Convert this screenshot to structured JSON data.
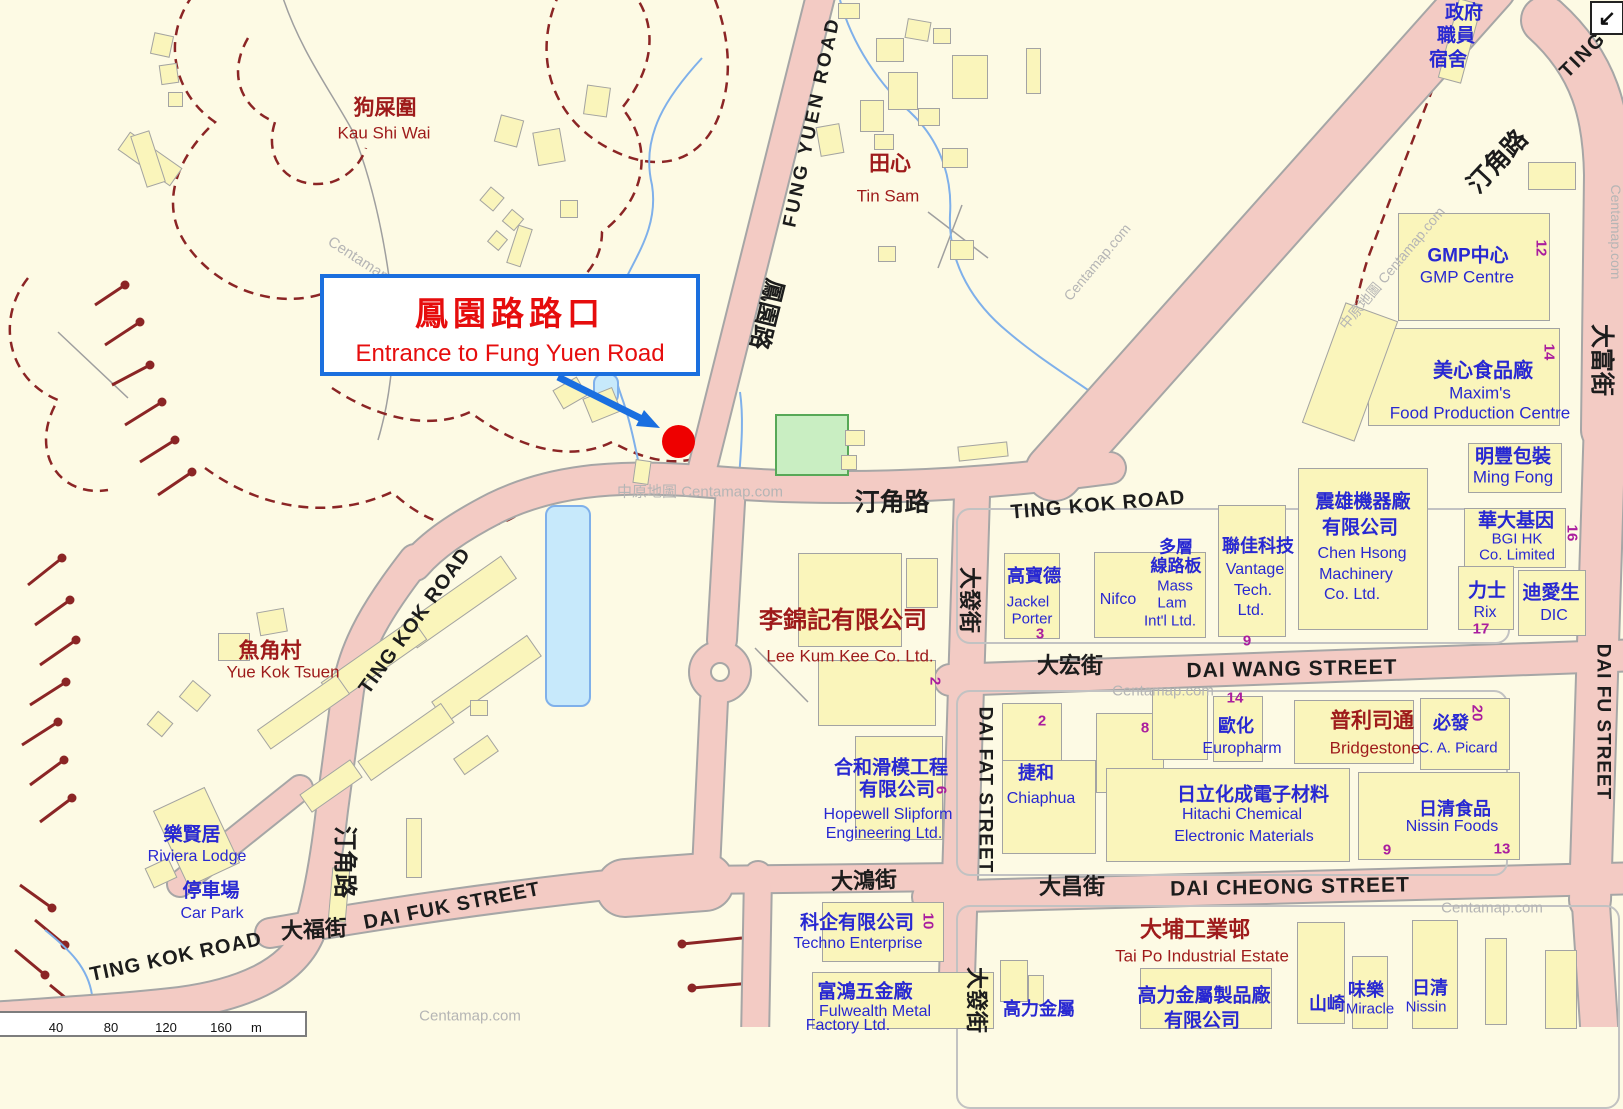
{
  "callout": {
    "title_zh": "鳳園路路口",
    "title_en": "Entrance to Fung Yuen Road"
  },
  "marker": {
    "type": "red-dot"
  },
  "nav_icon": {
    "glyph": "↙"
  },
  "scale_bar": {
    "ticks": [
      "40",
      "80",
      "120",
      "160"
    ],
    "unit": "m"
  },
  "colors": {
    "background": "#fdfae4",
    "road_fill": "#f3cbc4",
    "road_casing": "#a6a6a6",
    "building": "#faf5bb",
    "park": "#c9eec2",
    "water": "#7fb0ea",
    "contour": "#8b2525",
    "road_text": "#1c1c1c",
    "place_text": "#9e1b1b",
    "facility_text": "#2828d2",
    "lot_number_text": "#aa1d9e",
    "watermark_text": "#b5b5b5",
    "callout_border": "#1b6fde",
    "callout_text": "#e60d0d",
    "marker_red": "#ee0000"
  },
  "labels": [
    {
      "id": "fung-yuen-road",
      "t": "FUNG YUEN ROAD",
      "k": "road",
      "x": 812,
      "y": 122,
      "s": 19,
      "r": -78,
      "b": 1,
      "ls": 3
    },
    {
      "id": "fung-yuen-road-zh",
      "t": "鳳園路",
      "k": "road",
      "x": 766,
      "y": 314,
      "s": 24,
      "r": 104,
      "b": 1
    },
    {
      "id": "ting-kok-road-ne",
      "t": "TING",
      "k": "road",
      "x": 1583,
      "y": 55,
      "s": 20,
      "r": -45,
      "b": 1,
      "ls": 2
    },
    {
      "id": "ting-kok-road-ne-zh",
      "t": "汀角路",
      "k": "road",
      "x": 1498,
      "y": 162,
      "s": 25,
      "r": -47,
      "b": 1
    },
    {
      "id": "ting-kok-road-c",
      "t": "TING KOK ROAD",
      "k": "road",
      "x": 1098,
      "y": 505,
      "s": 20,
      "r": -5,
      "b": 1,
      "ls": 1
    },
    {
      "id": "ting-kok-road-c-zh",
      "t": "汀角路",
      "k": "road",
      "x": 892,
      "y": 503,
      "s": 25,
      "r": 0,
      "b": 1
    },
    {
      "id": "ting-kok-road-w",
      "t": "TING KOK ROAD",
      "k": "road",
      "x": 415,
      "y": 621,
      "s": 20,
      "r": -54,
      "b": 1,
      "ls": 1
    },
    {
      "id": "ting-kok-road-w-zh",
      "t": "汀角路",
      "k": "road",
      "x": 344,
      "y": 862,
      "s": 24,
      "r": 90,
      "b": 1
    },
    {
      "id": "ting-kok-road-sw",
      "t": "TING KOK ROAD",
      "k": "road",
      "x": 176,
      "y": 957,
      "s": 20,
      "r": -12,
      "b": 1,
      "ls": 1
    },
    {
      "id": "dai-fuk-street-zh",
      "t": "大福街",
      "k": "road",
      "x": 314,
      "y": 930,
      "s": 22,
      "r": -3,
      "b": 1
    },
    {
      "id": "dai-fuk-street",
      "t": "DAI FUK STREET",
      "k": "road",
      "x": 452,
      "y": 906,
      "s": 20,
      "r": -11,
      "b": 1,
      "ls": 1
    },
    {
      "id": "dai-hung-street-zh",
      "t": "大鴻街",
      "k": "road",
      "x": 864,
      "y": 881,
      "s": 22,
      "r": -2,
      "b": 1
    },
    {
      "id": "dai-fat-street-zh",
      "t": "大發街",
      "k": "road",
      "x": 969,
      "y": 600,
      "s": 22,
      "r": 90,
      "b": 1
    },
    {
      "id": "dai-fat-street",
      "t": "DAI FAT STREET",
      "k": "road",
      "x": 985,
      "y": 790,
      "s": 19,
      "r": 90,
      "b": 1,
      "ls": 1
    },
    {
      "id": "dai-fat-street-zh-s",
      "t": "大發街",
      "k": "road",
      "x": 976,
      "y": 1000,
      "s": 22,
      "r": 90,
      "b": 1
    },
    {
      "id": "dai-wang-street-zh",
      "t": "大宏街",
      "k": "road",
      "x": 1070,
      "y": 666,
      "s": 22,
      "r": 0,
      "b": 1
    },
    {
      "id": "dai-wang-street",
      "t": "DAI WANG STREET",
      "k": "road",
      "x": 1292,
      "y": 669,
      "s": 21,
      "r": -1,
      "b": 1,
      "ls": 1
    },
    {
      "id": "dai-cheong-street-zh",
      "t": "大昌街",
      "k": "road",
      "x": 1072,
      "y": 887,
      "s": 22,
      "r": 0,
      "b": 1
    },
    {
      "id": "dai-cheong-street",
      "t": "DAI CHEONG STREET",
      "k": "road",
      "x": 1290,
      "y": 887,
      "s": 21,
      "r": -1,
      "b": 1,
      "ls": 1
    },
    {
      "id": "dai-fu-street-zh",
      "t": "大富街",
      "k": "road",
      "x": 1601,
      "y": 360,
      "s": 24,
      "r": 90,
      "b": 1
    },
    {
      "id": "dai-fu-street",
      "t": "DAI FU STREET",
      "k": "road",
      "x": 1603,
      "y": 722,
      "s": 19,
      "r": 90,
      "b": 1,
      "ls": 1
    },
    {
      "id": "kau-shi-wai-zh",
      "t": "狗屎圍",
      "k": "place",
      "x": 385,
      "y": 108,
      "s": 21,
      "b": 1
    },
    {
      "id": "kau-shi-wai",
      "t": "Kau Shi Wai",
      "k": "place",
      "x": 384,
      "y": 133,
      "s": 17
    },
    {
      "id": "tin-sam-zh",
      "t": "田心",
      "k": "place",
      "x": 890,
      "y": 164,
      "s": 21,
      "b": 1
    },
    {
      "id": "tin-sam",
      "t": "Tin Sam",
      "k": "place",
      "x": 888,
      "y": 196,
      "s": 17
    },
    {
      "id": "yue-kok-tsuen-zh",
      "t": "魚角村",
      "k": "place",
      "x": 270,
      "y": 651,
      "s": 21,
      "b": 1
    },
    {
      "id": "yue-kok-tsuen",
      "t": "Yue Kok Tsuen",
      "k": "place",
      "x": 283,
      "y": 672,
      "s": 17
    },
    {
      "id": "lee-kum-kee-zh",
      "t": "李錦記有限公司",
      "k": "place",
      "x": 843,
      "y": 621,
      "s": 24,
      "b": 1
    },
    {
      "id": "lee-kum-kee",
      "t": "Lee Kum Kee Co. Ltd.",
      "k": "place",
      "x": 850,
      "y": 656,
      "s": 17
    },
    {
      "id": "tai-po-industrial-estate-zh",
      "t": "大埔工業邨",
      "k": "place",
      "x": 1195,
      "y": 930,
      "s": 22,
      "b": 1
    },
    {
      "id": "tai-po-industrial-estate",
      "t": "Tai Po Industrial Estate",
      "k": "place",
      "x": 1202,
      "y": 956,
      "s": 17
    },
    {
      "id": "bridgestone-zh",
      "t": "普利司通",
      "k": "place",
      "x": 1372,
      "y": 721,
      "s": 21,
      "b": 1
    },
    {
      "id": "bridgestone",
      "t": "Bridgestone",
      "k": "place",
      "x": 1375,
      "y": 748,
      "s": 17
    },
    {
      "id": "govt-quarters-zh-1",
      "t": "政府",
      "k": "fac",
      "x": 1464,
      "y": 13,
      "s": 19,
      "b": 1
    },
    {
      "id": "govt-quarters-zh-2",
      "t": "職員",
      "k": "fac",
      "x": 1456,
      "y": 36,
      "s": 19,
      "b": 1
    },
    {
      "id": "govt-quarters-zh-3",
      "t": "宿舍",
      "k": "fac",
      "x": 1448,
      "y": 60,
      "s": 19,
      "b": 1
    },
    {
      "id": "gmp-centre-zh",
      "t": "GMP中心",
      "k": "fac",
      "x": 1468,
      "y": 256,
      "s": 19,
      "b": 1
    },
    {
      "id": "gmp-centre",
      "t": "GMP Centre",
      "k": "fac",
      "x": 1467,
      "y": 277,
      "s": 17
    },
    {
      "id": "maxims-zh",
      "t": "美心食品廠",
      "k": "fac",
      "x": 1483,
      "y": 371,
      "s": 20,
      "b": 1
    },
    {
      "id": "maxims",
      "t": "Maxim's",
      "k": "fac",
      "x": 1480,
      "y": 393,
      "s": 17
    },
    {
      "id": "maxims-2",
      "t": "Food Production Centre",
      "k": "fac",
      "x": 1480,
      "y": 413,
      "s": 17
    },
    {
      "id": "ming-fong-zh",
      "t": "明豐包裝",
      "k": "fac",
      "x": 1513,
      "y": 457,
      "s": 19,
      "b": 1
    },
    {
      "id": "ming-fong",
      "t": "Ming Fong",
      "k": "fac",
      "x": 1513,
      "y": 477,
      "s": 17
    },
    {
      "id": "bgi-zh",
      "t": "華大基因",
      "k": "fac",
      "x": 1516,
      "y": 521,
      "s": 19,
      "b": 1
    },
    {
      "id": "bgi-1",
      "t": "BGI HK",
      "k": "fac",
      "x": 1517,
      "y": 539,
      "s": 15
    },
    {
      "id": "bgi-2",
      "t": "Co. Limited",
      "k": "fac",
      "x": 1517,
      "y": 555,
      "s": 15
    },
    {
      "id": "rix-zh",
      "t": "力士",
      "k": "fac",
      "x": 1487,
      "y": 591,
      "s": 19,
      "b": 1
    },
    {
      "id": "rix",
      "t": "Rix",
      "k": "fac",
      "x": 1485,
      "y": 613,
      "s": 16
    },
    {
      "id": "dic-zh",
      "t": "迪愛生",
      "k": "fac",
      "x": 1551,
      "y": 593,
      "s": 19,
      "b": 1
    },
    {
      "id": "dic",
      "t": "DIC",
      "k": "fac",
      "x": 1554,
      "y": 616,
      "s": 16
    },
    {
      "id": "chen-hsong-zh-1",
      "t": "震雄機器廠",
      "k": "fac",
      "x": 1363,
      "y": 502,
      "s": 19,
      "b": 1
    },
    {
      "id": "chen-hsong-zh-2",
      "t": "有限公司",
      "k": "fac",
      "x": 1360,
      "y": 528,
      "s": 19,
      "b": 1
    },
    {
      "id": "chen-hsong-1",
      "t": "Chen Hsong",
      "k": "fac",
      "x": 1362,
      "y": 554,
      "s": 16
    },
    {
      "id": "chen-hsong-2",
      "t": "Machinery",
      "k": "fac",
      "x": 1356,
      "y": 575,
      "s": 16
    },
    {
      "id": "chen-hsong-3",
      "t": "Co. Ltd.",
      "k": "fac",
      "x": 1352,
      "y": 595,
      "s": 16
    },
    {
      "id": "vantage-zh",
      "t": "聯佳科技",
      "k": "fac",
      "x": 1258,
      "y": 546,
      "s": 18,
      "b": 1
    },
    {
      "id": "vantage-1",
      "t": "Vantage",
      "k": "fac",
      "x": 1255,
      "y": 570,
      "s": 16
    },
    {
      "id": "vantage-2",
      "t": "Tech.",
      "k": "fac",
      "x": 1253,
      "y": 591,
      "s": 16
    },
    {
      "id": "vantage-3",
      "t": "Ltd.",
      "k": "fac",
      "x": 1251,
      "y": 611,
      "s": 16
    },
    {
      "id": "mass-lam-zh-1",
      "t": "多層",
      "k": "fac",
      "x": 1176,
      "y": 547,
      "s": 17,
      "b": 1
    },
    {
      "id": "mass-lam-zh-2",
      "t": "線路板",
      "k": "fac",
      "x": 1176,
      "y": 566,
      "s": 17,
      "b": 1
    },
    {
      "id": "mass-lam-1",
      "t": "Mass",
      "k": "fac",
      "x": 1175,
      "y": 586,
      "s": 15
    },
    {
      "id": "mass-lam-2",
      "t": "Lam",
      "k": "fac",
      "x": 1172,
      "y": 603,
      "s": 15
    },
    {
      "id": "mass-lam-3",
      "t": "Int'l Ltd.",
      "k": "fac",
      "x": 1170,
      "y": 621,
      "s": 15
    },
    {
      "id": "nifco",
      "t": "Nifco",
      "k": "fac",
      "x": 1118,
      "y": 600,
      "s": 16
    },
    {
      "id": "jackel-porter-zh",
      "t": "高寶德",
      "k": "fac",
      "x": 1034,
      "y": 576,
      "s": 18,
      "b": 1
    },
    {
      "id": "jackel-porter-1",
      "t": "Jackel",
      "k": "fac",
      "x": 1028,
      "y": 602,
      "s": 15
    },
    {
      "id": "jackel-porter-2",
      "t": "Porter",
      "k": "fac",
      "x": 1032,
      "y": 619,
      "s": 15
    },
    {
      "id": "europharm-zh",
      "t": "歐化",
      "k": "fac",
      "x": 1236,
      "y": 726,
      "s": 18,
      "b": 1
    },
    {
      "id": "europharm",
      "t": "Europharm",
      "k": "fac",
      "x": 1242,
      "y": 749,
      "s": 16
    },
    {
      "id": "ca-picard-zh",
      "t": "必發",
      "k": "fac",
      "x": 1451,
      "y": 723,
      "s": 18,
      "b": 1
    },
    {
      "id": "ca-picard",
      "t": "C. A. Picard",
      "k": "fac",
      "x": 1458,
      "y": 748,
      "s": 15
    },
    {
      "id": "chiaphua-zh",
      "t": "捷和",
      "k": "fac",
      "x": 1036,
      "y": 773,
      "s": 18,
      "b": 1
    },
    {
      "id": "chiaphua",
      "t": "Chiaphua",
      "k": "fac",
      "x": 1041,
      "y": 799,
      "s": 16
    },
    {
      "id": "hitachi-zh",
      "t": "日立化成電子材料",
      "k": "fac",
      "x": 1253,
      "y": 795,
      "s": 19,
      "b": 1
    },
    {
      "id": "hitachi-1",
      "t": "Hitachi Chemical",
      "k": "fac",
      "x": 1242,
      "y": 815,
      "s": 16
    },
    {
      "id": "hitachi-2",
      "t": "Electronic Materials",
      "k": "fac",
      "x": 1244,
      "y": 837,
      "s": 16
    },
    {
      "id": "nissin-foods-zh",
      "t": "日清食品",
      "k": "fac",
      "x": 1455,
      "y": 809,
      "s": 18,
      "b": 1
    },
    {
      "id": "nissin-foods",
      "t": "Nissin Foods",
      "k": "fac",
      "x": 1452,
      "y": 827,
      "s": 16
    },
    {
      "id": "hopewell-zh-1",
      "t": "合和滑模工程",
      "k": "fac",
      "x": 891,
      "y": 768,
      "s": 19,
      "b": 1
    },
    {
      "id": "hopewell-zh-2",
      "t": "有限公司",
      "k": "fac",
      "x": 897,
      "y": 790,
      "s": 19,
      "b": 1
    },
    {
      "id": "hopewell-1",
      "t": "Hopewell Slipform",
      "k": "fac",
      "x": 888,
      "y": 815,
      "s": 16
    },
    {
      "id": "hopewell-2",
      "t": "Engineering Ltd.",
      "k": "fac",
      "x": 884,
      "y": 834,
      "s": 16
    },
    {
      "id": "techno-zh",
      "t": "科企有限公司",
      "k": "fac",
      "x": 857,
      "y": 923,
      "s": 19,
      "b": 1
    },
    {
      "id": "techno",
      "t": "Techno Enterprise",
      "k": "fac",
      "x": 858,
      "y": 944,
      "s": 16
    },
    {
      "id": "fulwealth-zh",
      "t": "富鴻五金廠",
      "k": "fac",
      "x": 865,
      "y": 992,
      "s": 19,
      "b": 1
    },
    {
      "id": "fulwealth-1",
      "t": "Fulwealth Metal",
      "k": "fac",
      "x": 875,
      "y": 1012,
      "s": 16
    },
    {
      "id": "fulwealth-2",
      "t": "Factory Ltd.",
      "k": "fac",
      "x": 848,
      "y": 1026,
      "s": 16
    },
    {
      "id": "ko-lik-zh",
      "t": "高力金屬",
      "k": "fac",
      "x": 1039,
      "y": 1009,
      "s": 18,
      "b": 1
    },
    {
      "id": "ko-lik-factory-zh-1",
      "t": "高力金屬製品廠",
      "k": "fac",
      "x": 1204,
      "y": 996,
      "s": 19,
      "b": 1
    },
    {
      "id": "ko-lik-factory-zh-2",
      "t": "有限公司",
      "k": "fac",
      "x": 1202,
      "y": 1021,
      "s": 19,
      "b": 1
    },
    {
      "id": "yamazaki-zh",
      "t": "山崎",
      "k": "fac",
      "x": 1327,
      "y": 1004,
      "s": 18,
      "b": 1
    },
    {
      "id": "miracle-zh",
      "t": "味樂",
      "k": "fac",
      "x": 1366,
      "y": 990,
      "s": 18,
      "b": 1
    },
    {
      "id": "miracle",
      "t": "Miracle",
      "k": "fac",
      "x": 1370,
      "y": 1009,
      "s": 15
    },
    {
      "id": "nissin-zh",
      "t": "日清",
      "k": "fac",
      "x": 1430,
      "y": 988,
      "s": 18,
      "b": 1
    },
    {
      "id": "nissin",
      "t": "Nissin",
      "k": "fac",
      "x": 1426,
      "y": 1007,
      "s": 15
    },
    {
      "id": "riviera-lodge-zh",
      "t": "樂賢居",
      "k": "fac",
      "x": 192,
      "y": 835,
      "s": 19,
      "b": 1
    },
    {
      "id": "riviera-lodge",
      "t": "Riviera Lodge",
      "k": "fac",
      "x": 197,
      "y": 857,
      "s": 16
    },
    {
      "id": "car-park-zh",
      "t": "停車場",
      "k": "fac",
      "x": 211,
      "y": 891,
      "s": 19,
      "b": 1
    },
    {
      "id": "car-park",
      "t": "Car Park",
      "k": "fac",
      "x": 212,
      "y": 914,
      "s": 16
    },
    {
      "id": "lot-12",
      "t": "12",
      "k": "num",
      "x": 1541,
      "y": 248,
      "s": 15,
      "r": 90
    },
    {
      "id": "lot-14a",
      "t": "14",
      "k": "num",
      "x": 1549,
      "y": 352,
      "s": 15,
      "r": 90
    },
    {
      "id": "lot-16",
      "t": "16",
      "k": "num",
      "x": 1572,
      "y": 533,
      "s": 15,
      "r": 90
    },
    {
      "id": "lot-17",
      "t": "17",
      "k": "num",
      "x": 1481,
      "y": 629,
      "s": 15
    },
    {
      "id": "lot-3",
      "t": "3",
      "k": "num",
      "x": 1040,
      "y": 634,
      "s": 15
    },
    {
      "id": "lot-9a",
      "t": "9",
      "k": "num",
      "x": 1247,
      "y": 641,
      "s": 15
    },
    {
      "id": "lot-2a",
      "t": "2",
      "k": "num",
      "x": 1042,
      "y": 721,
      "s": 15
    },
    {
      "id": "lot-8",
      "t": "8",
      "k": "num",
      "x": 1145,
      "y": 728,
      "s": 15
    },
    {
      "id": "lot-14b",
      "t": "14",
      "k": "num",
      "x": 1235,
      "y": 698,
      "s": 15
    },
    {
      "id": "lot-20",
      "t": "20",
      "k": "num",
      "x": 1477,
      "y": 713,
      "s": 15,
      "r": 90
    },
    {
      "id": "lot-2b",
      "t": "2",
      "k": "num",
      "x": 935,
      "y": 681,
      "s": 15,
      "r": 90
    },
    {
      "id": "lot-6",
      "t": "6",
      "k": "num",
      "x": 941,
      "y": 790,
      "s": 15,
      "r": 90
    },
    {
      "id": "lot-10",
      "t": "10",
      "k": "num",
      "x": 928,
      "y": 921,
      "s": 15,
      "r": 90
    },
    {
      "id": "lot-9b",
      "t": "9",
      "k": "num",
      "x": 1387,
      "y": 850,
      "s": 15
    },
    {
      "id": "lot-13",
      "t": "13",
      "k": "num",
      "x": 1502,
      "y": 849,
      "s": 15
    },
    {
      "id": "watermark-1",
      "t": "Centamap.com",
      "k": "wm",
      "x": 372,
      "y": 268,
      "s": 15,
      "r": 33
    },
    {
      "id": "watermark-2",
      "t": "中原地圖 Centamap.com",
      "k": "wm",
      "x": 700,
      "y": 492,
      "s": 15
    },
    {
      "id": "watermark-3",
      "t": "Centamap.com",
      "k": "wm",
      "x": 1163,
      "y": 691,
      "s": 15
    },
    {
      "id": "watermark-4",
      "t": "Centamap.com",
      "k": "wm",
      "x": 1616,
      "y": 232,
      "s": 14,
      "r": 90
    },
    {
      "id": "watermark-5",
      "t": "Centamap.com",
      "k": "wm",
      "x": 1097,
      "y": 262,
      "s": 14,
      "r": -50
    },
    {
      "id": "watermark-6",
      "t": "中原地圖 Centamap.com",
      "k": "wm",
      "x": 1392,
      "y": 268,
      "s": 14,
      "r": -50
    },
    {
      "id": "watermark-7",
      "t": "Centamap.com",
      "k": "wm",
      "x": 470,
      "y": 1016,
      "s": 15
    },
    {
      "id": "watermark-8",
      "t": "Centamap.com",
      "k": "wm",
      "x": 1492,
      "y": 908,
      "s": 15
    }
  ]
}
